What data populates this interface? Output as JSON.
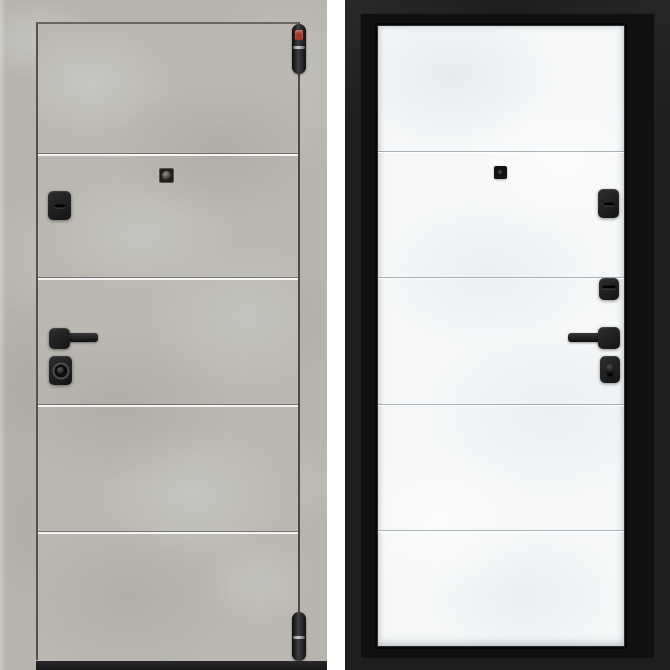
{
  "meta": {
    "subject": "Steel entrance door product photos: exterior side in grey concrete finish (left) and interior side in white leaf with black frame (right)"
  },
  "colors": {
    "page_bg": "#ffffff",
    "concrete": "#b6b4ad",
    "concrete_light": "#ccc9c2",
    "concrete_dark": "#9e9c95",
    "leaf_edge_dark": "#56544e",
    "threshold": "#161616",
    "leaf_white": "#f5f7f8",
    "leaf_white_shade": "#dde4e8",
    "frame_black": "#1e1e1e",
    "frame_black_deep": "#101010",
    "hardware_black": "#1c1c1c",
    "hinge_sticker_red": "#a8322a"
  },
  "exterior_door": {
    "label": "exterior-side-grey-concrete",
    "panel_count": 5,
    "panel_seam_y": [
      153,
      277,
      404,
      531
    ],
    "hardware": [
      "top-hinge",
      "bottom-hinge",
      "peephole",
      "keyhole-escutcheon",
      "lever-handle",
      "cylinder-lock"
    ]
  },
  "interior_door": {
    "label": "interior-side-white-black-frame",
    "panel_count": 5,
    "panel_seam_y": [
      150,
      276,
      403,
      529
    ],
    "hardware": [
      "peephole",
      "keyhole-escutcheon",
      "night-lock-escutcheon",
      "lever-handle",
      "thumbturn-lock"
    ]
  }
}
